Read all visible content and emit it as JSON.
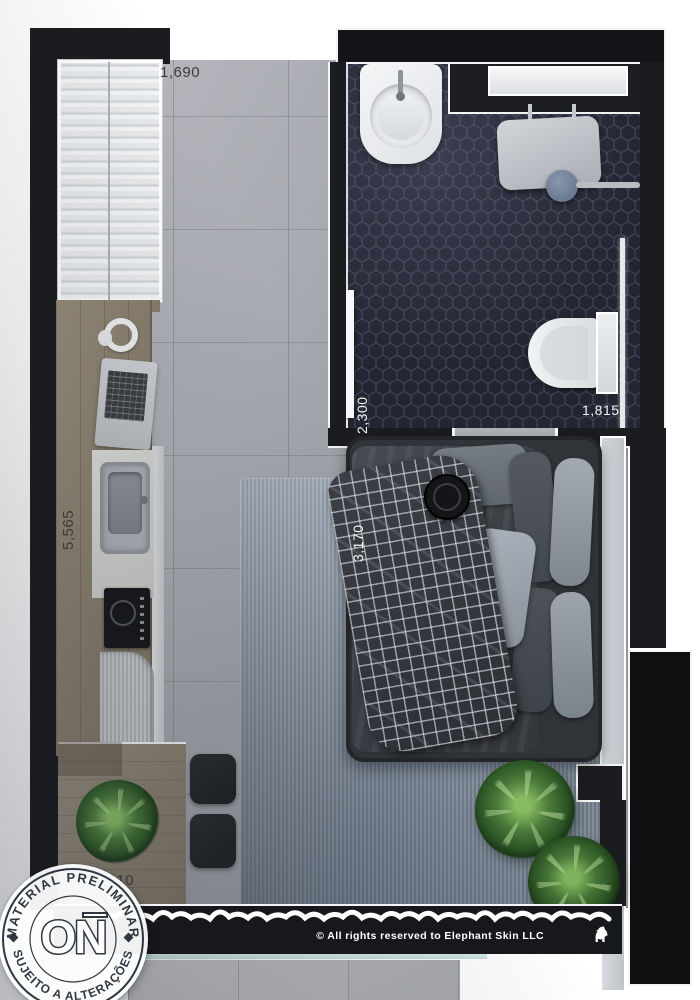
{
  "plan": {
    "dimensions": {
      "window": "1,690",
      "bathroom_depth": "2,300",
      "bathroom_width": "1,815",
      "bed": "3,170",
      "kitchen": "5,565",
      "table": "2,210"
    },
    "watermark": {
      "arc_top": "MATERIAL PRELIMINAR",
      "arc_bottom": "SUJEITO A ALTERAÇÕES",
      "logo": "ON"
    },
    "copyright": "© All rights reserved to Elephant Skin LLC",
    "colors": {
      "wall": "#1b1c1f",
      "concrete_floor": "#a6a8ae",
      "wood": "#8d8271",
      "bath_tile": "#232532",
      "rug": "#8792a0",
      "glass": "#c2e0da",
      "plant": "#4c7c3b",
      "stamp_ink": "#2e3842"
    }
  }
}
